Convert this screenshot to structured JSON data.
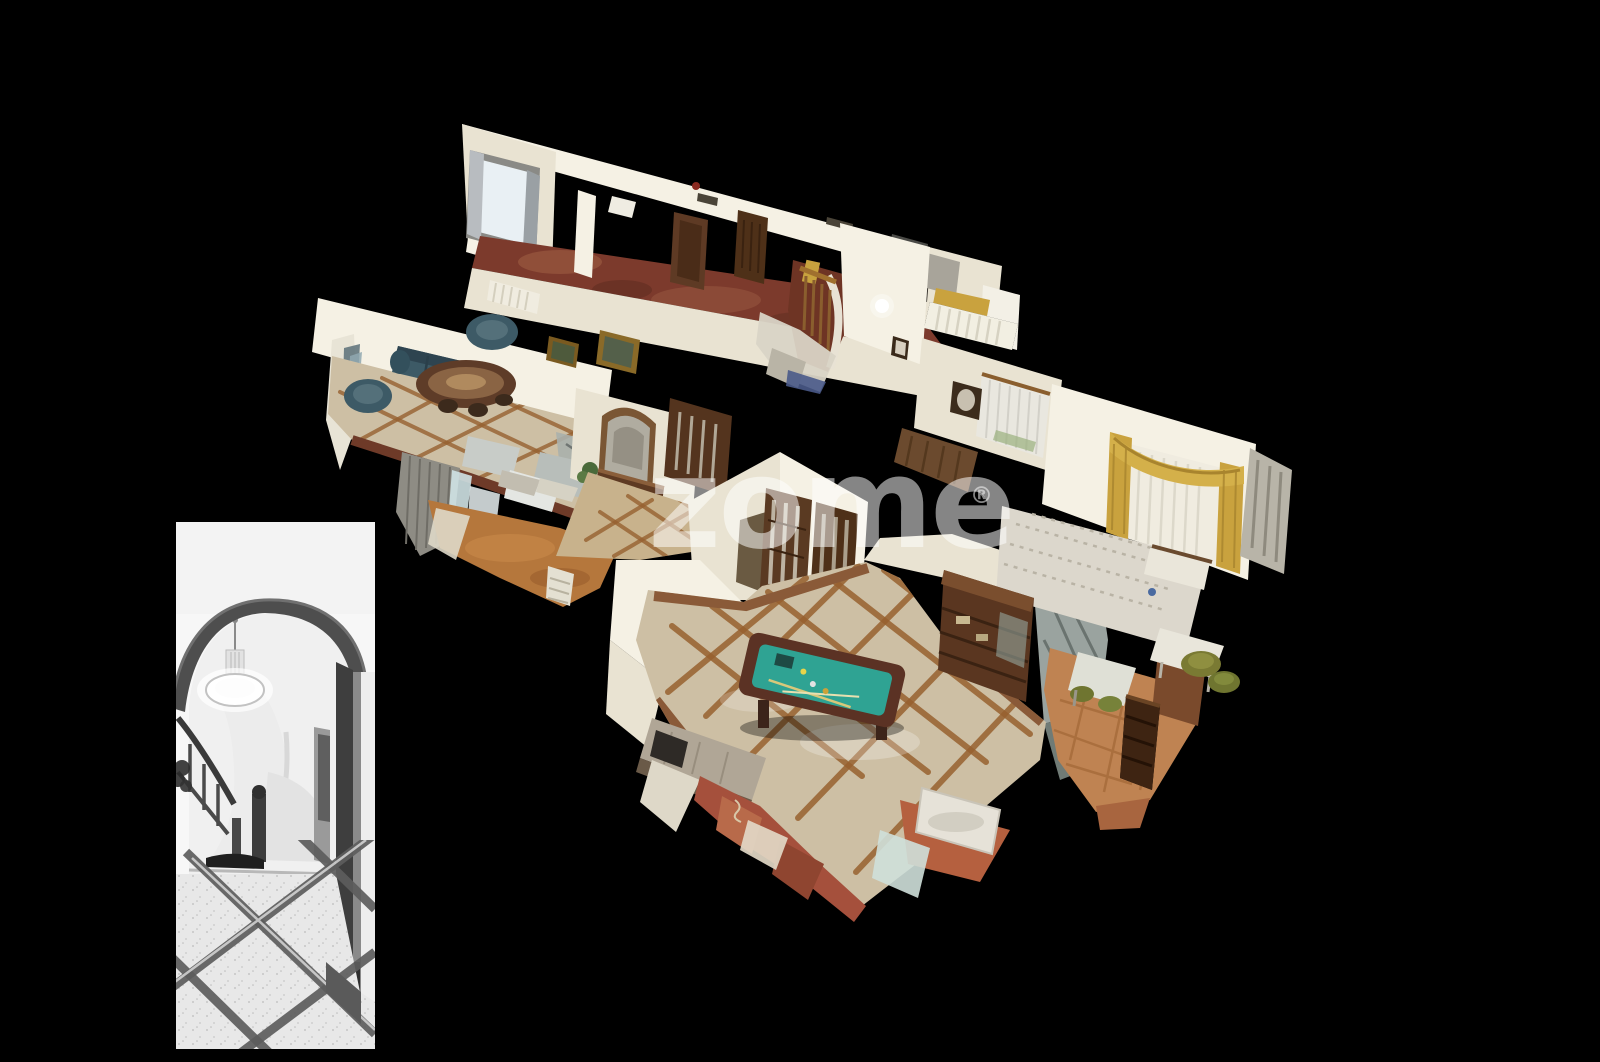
{
  "canvas": {
    "width": 1600,
    "height": 1062
  },
  "watermark": {
    "text": "zome",
    "registered": "®"
  },
  "palette": {
    "background": "#000000",
    "wall": "#e9e3d2",
    "wall_bright": "#f5f1e4",
    "wall_shadow": "#d6cfba",
    "wood_floor": "#7c3a2c",
    "tile": "#cdbfa4",
    "tile_grid": "#96602f",
    "hall_floor": "#c8b28c",
    "orange_floor": "#b5773c",
    "terracotta": "#a5503c",
    "pool_felt": "#2fa393",
    "pool_wood": "#5b3224",
    "sofa": "#3d5a66",
    "cabinet": "#5a3620",
    "gold": "#c9a23e",
    "bed": "#dcd7cc",
    "green_chair": "#7a7a33",
    "artifact_gray": "#9aa39f",
    "watermark": "rgba(255,255,255,0.52)",
    "photo_bg": "#f7f7f7",
    "photo_dark": "#434343",
    "photo_floor": "#e8e8e8",
    "photo_band": "#5c5c5c"
  },
  "dollhouse": {
    "kind": "3d-dollhouse-scan",
    "rooms": [
      "upper-hallway-wood-floor",
      "window-with-gray-curtains",
      "living-room-blue-leather-sofas",
      "oval-dining-table",
      "entry-hall-mirror-and-console",
      "wood-glazed-double-doors",
      "spiral-staircase",
      "billiard-room",
      "pool-table",
      "display-cabinet",
      "kitchen-counter",
      "bedroom-gold-curtains",
      "bed",
      "green-chairs",
      "terracotta-floor",
      "scan-artifacts"
    ]
  },
  "inset_photo": {
    "kind": "monochrome-photo",
    "subject": [
      "arched-doorway",
      "pendant-lamp",
      "curved-staircase",
      "stair-railing",
      "tiled-marble-floor",
      "door-frame"
    ]
  }
}
